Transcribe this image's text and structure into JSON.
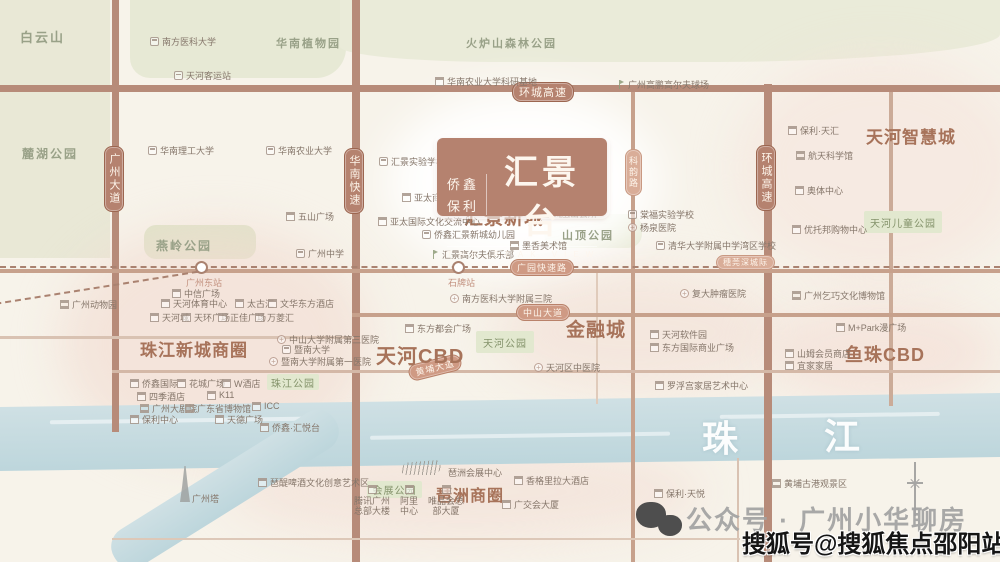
{
  "logo": {
    "brand_top": "侨鑫",
    "brand_bottom": "保利",
    "name": "汇景台",
    "english": "THE PEAK VIEW"
  },
  "river": {
    "char_1": "珠",
    "char_2": "江"
  },
  "watermarks": {
    "wechat_account": "公众号 · 广州小华聊房",
    "sohu_account": "搜狐号@搜狐焦点邵阳站"
  },
  "colors": {
    "road": "#b78b79",
    "badge_dark": "#b5826f",
    "badge_mid": "#cf9a84",
    "district_text": "#a7735a",
    "nature_text": "#99a188",
    "park_box_bg": "#e2e8cf",
    "river": "#c6dbe0",
    "poi_text": "#85766a"
  },
  "districts": [
    {
      "label": "汇景新城",
      "x": 464,
      "y": 203,
      "fs": 19
    },
    {
      "label": "天河CBD",
      "x": 376,
      "y": 340,
      "fs": 20
    },
    {
      "label": "金融城",
      "x": 566,
      "y": 315,
      "fs": 19
    },
    {
      "label": "鱼珠CBD",
      "x": 845,
      "y": 341,
      "fs": 18
    },
    {
      "label": "珠江新城商圈",
      "x": 140,
      "y": 336,
      "fs": 17
    },
    {
      "label": "琶洲商圈",
      "x": 436,
      "y": 482,
      "fs": 16
    },
    {
      "label": "天河智慧城",
      "x": 866,
      "y": 123,
      "fs": 17
    }
  ],
  "nature": [
    {
      "label": "白云山",
      "x": 20,
      "y": 27,
      "fs": 13
    },
    {
      "label": "麓湖公园",
      "x": 22,
      "y": 145,
      "fs": 12
    },
    {
      "label": "华南植物园",
      "x": 276,
      "y": 35,
      "fs": 11
    },
    {
      "label": "火炉山森林公园",
      "x": 466,
      "y": 35,
      "fs": 11
    },
    {
      "label": "燕岭公园",
      "x": 156,
      "y": 237,
      "fs": 12
    },
    {
      "label": "山顶公园",
      "x": 562,
      "y": 227,
      "fs": 11
    }
  ],
  "parks": [
    {
      "label": "天河公园",
      "x": 476,
      "y": 331,
      "w": 58,
      "h": 22
    },
    {
      "label": "珠江公园",
      "x": 267,
      "y": 374,
      "w": 52,
      "h": 16
    },
    {
      "label": "天河儿童公园",
      "x": 864,
      "y": 211,
      "w": 78,
      "h": 22
    },
    {
      "label": "会展公园",
      "x": 367,
      "y": 481,
      "w": 55,
      "h": 17
    }
  ],
  "road_badges": [
    {
      "label": "环城高速",
      "x": 512,
      "y": 82,
      "o": "h",
      "v": "dark",
      "fs": 11
    },
    {
      "label": "广园快速路",
      "x": 510,
      "y": 259,
      "o": "h",
      "v": "mid",
      "fs": 9
    },
    {
      "label": "穗莞深城际",
      "x": 716,
      "y": 255,
      "o": "h",
      "v": "light",
      "fs": 8
    },
    {
      "label": "中山大道",
      "x": 516,
      "y": 304,
      "o": "h",
      "v": "mid",
      "fs": 9
    },
    {
      "label": "黄埔大道",
      "x": 408,
      "y": 359,
      "o": "h",
      "v": "mid",
      "fs": 9,
      "rot": -14
    },
    {
      "label": "广州大道",
      "x": 104,
      "y": 146,
      "o": "v",
      "v": "dark",
      "fs": 11
    },
    {
      "label": "华南快速",
      "x": 344,
      "y": 148,
      "o": "v",
      "v": "dark",
      "fs": 11
    },
    {
      "label": "科韵路",
      "x": 625,
      "y": 149,
      "o": "v",
      "v": "light",
      "fs": 9
    },
    {
      "label": "环城高速",
      "x": 756,
      "y": 145,
      "o": "v",
      "v": "dark",
      "fs": 11
    }
  ],
  "pois": [
    {
      "t": "南方医科大学",
      "x": 150,
      "y": 35,
      "ic": "school"
    },
    {
      "t": "天河客运站",
      "x": 174,
      "y": 69,
      "ic": "bus"
    },
    {
      "t": "华南理工大学",
      "x": 148,
      "y": 144,
      "ic": "school"
    },
    {
      "t": "华南农业大学",
      "x": 266,
      "y": 144,
      "ic": "school"
    },
    {
      "t": "华南农业大学科研基地",
      "x": 435,
      "y": 75,
      "ic": "building"
    },
    {
      "t": "广州高鹏高尔夫球场",
      "x": 616,
      "y": 78,
      "ic": "golf"
    },
    {
      "t": "保利·天汇",
      "x": 788,
      "y": 124,
      "ic": "building"
    },
    {
      "t": "航天科学馆",
      "x": 796,
      "y": 149,
      "ic": "museum"
    },
    {
      "t": "奥体中心",
      "x": 795,
      "y": 184,
      "ic": "building"
    },
    {
      "t": "优托邦购物中心",
      "x": 792,
      "y": 223,
      "ic": "building"
    },
    {
      "t": "棠福实验学校",
      "x": 628,
      "y": 208,
      "ic": "school"
    },
    {
      "t": "杨泉医院",
      "x": 628,
      "y": 221,
      "ic": "hospital"
    },
    {
      "t": "清华大学附属中学湾区学校",
      "x": 656,
      "y": 239,
      "ic": "school"
    },
    {
      "t": "汇景实验学校",
      "x": 379,
      "y": 155,
      "ic": "school"
    },
    {
      "t": "亚太商汇",
      "x": 402,
      "y": 191,
      "ic": "building"
    },
    {
      "t": "亚太国际文化交流中心",
      "x": 378,
      "y": 215,
      "ic": "building"
    },
    {
      "t": "侨鑫汇景新城幼儿园",
      "x": 422,
      "y": 228,
      "ic": "school"
    },
    {
      "t": "汇景高尔夫俱乐部",
      "x": 430,
      "y": 248,
      "ic": "golf"
    },
    {
      "t": "凤凰山会所",
      "x": 540,
      "y": 207,
      "ic": "building"
    },
    {
      "t": "墨香美术馆",
      "x": 510,
      "y": 239,
      "ic": "museum"
    },
    {
      "t": "五山广场",
      "x": 286,
      "y": 210,
      "ic": "building"
    },
    {
      "t": "广州中学",
      "x": 296,
      "y": 247,
      "ic": "school"
    },
    {
      "t": "广州动物园",
      "x": 60,
      "y": 298,
      "ic": "museum"
    },
    {
      "t": "广州东站",
      "x": 186,
      "y": 276,
      "cls": "rosy"
    },
    {
      "t": "中信广场",
      "x": 172,
      "y": 287,
      "ic": "building"
    },
    {
      "t": "天河体育中心",
      "x": 161,
      "y": 297,
      "ic": "building"
    },
    {
      "t": "太古汇",
      "x": 235,
      "y": 297,
      "ic": "building"
    },
    {
      "t": "文华东方酒店",
      "x": 268,
      "y": 297,
      "ic": "building"
    },
    {
      "t": "天河城",
      "x": 150,
      "y": 311,
      "ic": "building"
    },
    {
      "t": "天环广场",
      "x": 182,
      "y": 311,
      "ic": "building"
    },
    {
      "t": "正佳广场",
      "x": 218,
      "y": 311,
      "ic": "building"
    },
    {
      "t": "万菱汇",
      "x": 255,
      "y": 311,
      "ic": "building"
    },
    {
      "t": "中山大学附属第三医院",
      "x": 277,
      "y": 333,
      "ic": "hospital"
    },
    {
      "t": "暨南大学",
      "x": 282,
      "y": 343,
      "ic": "school"
    },
    {
      "t": "暨南大学附属第一医院",
      "x": 269,
      "y": 355,
      "ic": "hospital"
    },
    {
      "t": "侨鑫国际",
      "x": 130,
      "y": 377,
      "ic": "building"
    },
    {
      "t": "花城广场",
      "x": 177,
      "y": 377,
      "ic": "building"
    },
    {
      "t": "W酒店",
      "x": 222,
      "y": 377,
      "ic": "building"
    },
    {
      "t": "四季酒店",
      "x": 137,
      "y": 390,
      "ic": "building"
    },
    {
      "t": "K11",
      "x": 207,
      "y": 390,
      "ic": "building"
    },
    {
      "t": "广州大剧院",
      "x": 140,
      "y": 402,
      "ic": "museum"
    },
    {
      "t": "广东省博物馆",
      "x": 185,
      "y": 402,
      "ic": "museum"
    },
    {
      "t": "ICC",
      "x": 252,
      "y": 401,
      "ic": "building"
    },
    {
      "t": "保利中心",
      "x": 130,
      "y": 413,
      "ic": "building"
    },
    {
      "t": "天德广场",
      "x": 215,
      "y": 413,
      "ic": "building"
    },
    {
      "t": "侨鑫·汇悦台",
      "x": 260,
      "y": 421,
      "ic": "building"
    },
    {
      "t": "东方都会广场",
      "x": 405,
      "y": 322,
      "ic": "building"
    },
    {
      "t": "南方医科大学附属三院",
      "x": 450,
      "y": 292,
      "ic": "hospital"
    },
    {
      "t": "石牌站",
      "x": 448,
      "y": 276,
      "cls": "rosy"
    },
    {
      "t": "天河区中医院",
      "x": 534,
      "y": 361,
      "ic": "hospital"
    },
    {
      "t": "复大肿瘤医院",
      "x": 680,
      "y": 287,
      "ic": "hospital"
    },
    {
      "t": "天河软件园",
      "x": 650,
      "y": 328,
      "ic": "building"
    },
    {
      "t": "东方国际商业广场",
      "x": 650,
      "y": 341,
      "ic": "building"
    },
    {
      "t": "罗浮宫家居艺术中心",
      "x": 655,
      "y": 379,
      "ic": "building"
    },
    {
      "t": "广州乞巧文化博物馆",
      "x": 792,
      "y": 289,
      "ic": "museum"
    },
    {
      "t": "M+Park漫广场",
      "x": 836,
      "y": 321,
      "ic": "building"
    },
    {
      "t": "山姆会员商店",
      "x": 785,
      "y": 347,
      "ic": "building"
    },
    {
      "t": "宜家家居",
      "x": 785,
      "y": 359,
      "ic": "building"
    },
    {
      "t": "广州塔",
      "x": 192,
      "y": 492
    },
    {
      "t": "琶醍啤酒文化创意艺术区",
      "x": 258,
      "y": 476,
      "ic": "building"
    },
    {
      "t": "腾讯广州总部大楼",
      "x": 352,
      "y": 485,
      "ic": "building",
      "stack": true,
      "w": 40
    },
    {
      "t": "阿里中心",
      "x": 398,
      "y": 485,
      "ic": "building",
      "stack": true,
      "w": 22
    },
    {
      "t": "唯品会总部大厦",
      "x": 426,
      "y": 485,
      "ic": "building",
      "stack": true,
      "w": 40
    },
    {
      "t": "琶洲会展中心",
      "x": 448,
      "y": 466
    },
    {
      "t": "香格里拉大酒店",
      "x": 514,
      "y": 474,
      "ic": "building"
    },
    {
      "t": "广交会大厦",
      "x": 502,
      "y": 498,
      "ic": "building"
    },
    {
      "t": "保利·天悦",
      "x": 654,
      "y": 487,
      "ic": "building"
    },
    {
      "t": "黄埔古港观景区",
      "x": 772,
      "y": 477,
      "ic": "museum"
    }
  ]
}
